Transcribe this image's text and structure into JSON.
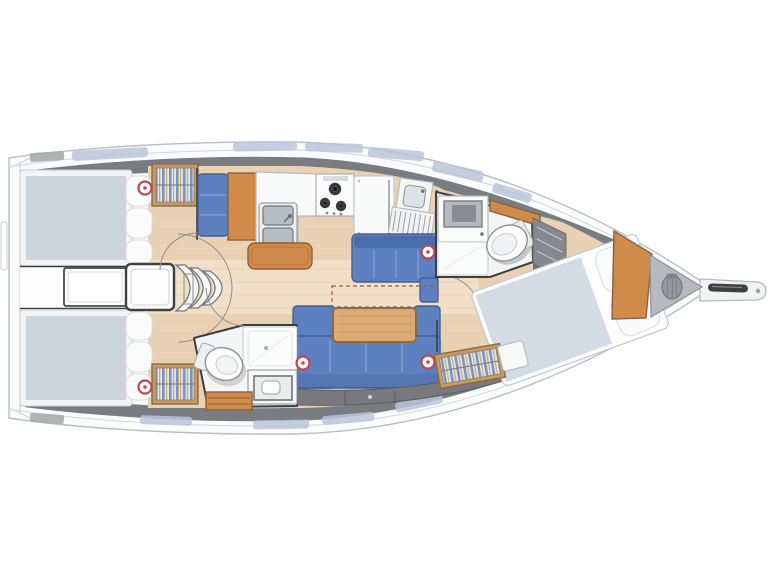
{
  "image": {
    "kind": "sailboat-interior-floorplan-top-view",
    "background": "#ffffff"
  },
  "colors": {
    "hull_fill": "#fbfcfc",
    "hull_outline": "#b9bdc2",
    "deck_band": "#74777c",
    "deck_panel": "#b9c5da",
    "wood_floor": "#e9d2b4",
    "wood_furniture": "#d08a49",
    "table_wood": "#dcab75",
    "upholstery_blue": "#5d80c0",
    "upholstery_blue_dark": "#416099",
    "mattress_gray": "#ccd3da",
    "bed_duvet": "#d3dce4",
    "pillow_white": "#fafbfb",
    "stainless": "#b7bdc3",
    "wall_dark": "#3c3e40",
    "locker_gray": "#85888c",
    "storage_gray": "#77797d",
    "anchor_locker": "#b6b9bd",
    "vent_red": "#c2454e",
    "dash_line": "#9a5a45",
    "wardrobe_frame": "#c59a66"
  },
  "features": {
    "aft_cabins": 2,
    "heads": 2,
    "forward_cabins": 1,
    "companionway_steps": 3,
    "stove_burners": 3,
    "galley_sink_basins": 2,
    "vent_markers": 5,
    "salon_sofas": 2,
    "anchor_chain_bag": 1,
    "bowsprit": 1
  }
}
